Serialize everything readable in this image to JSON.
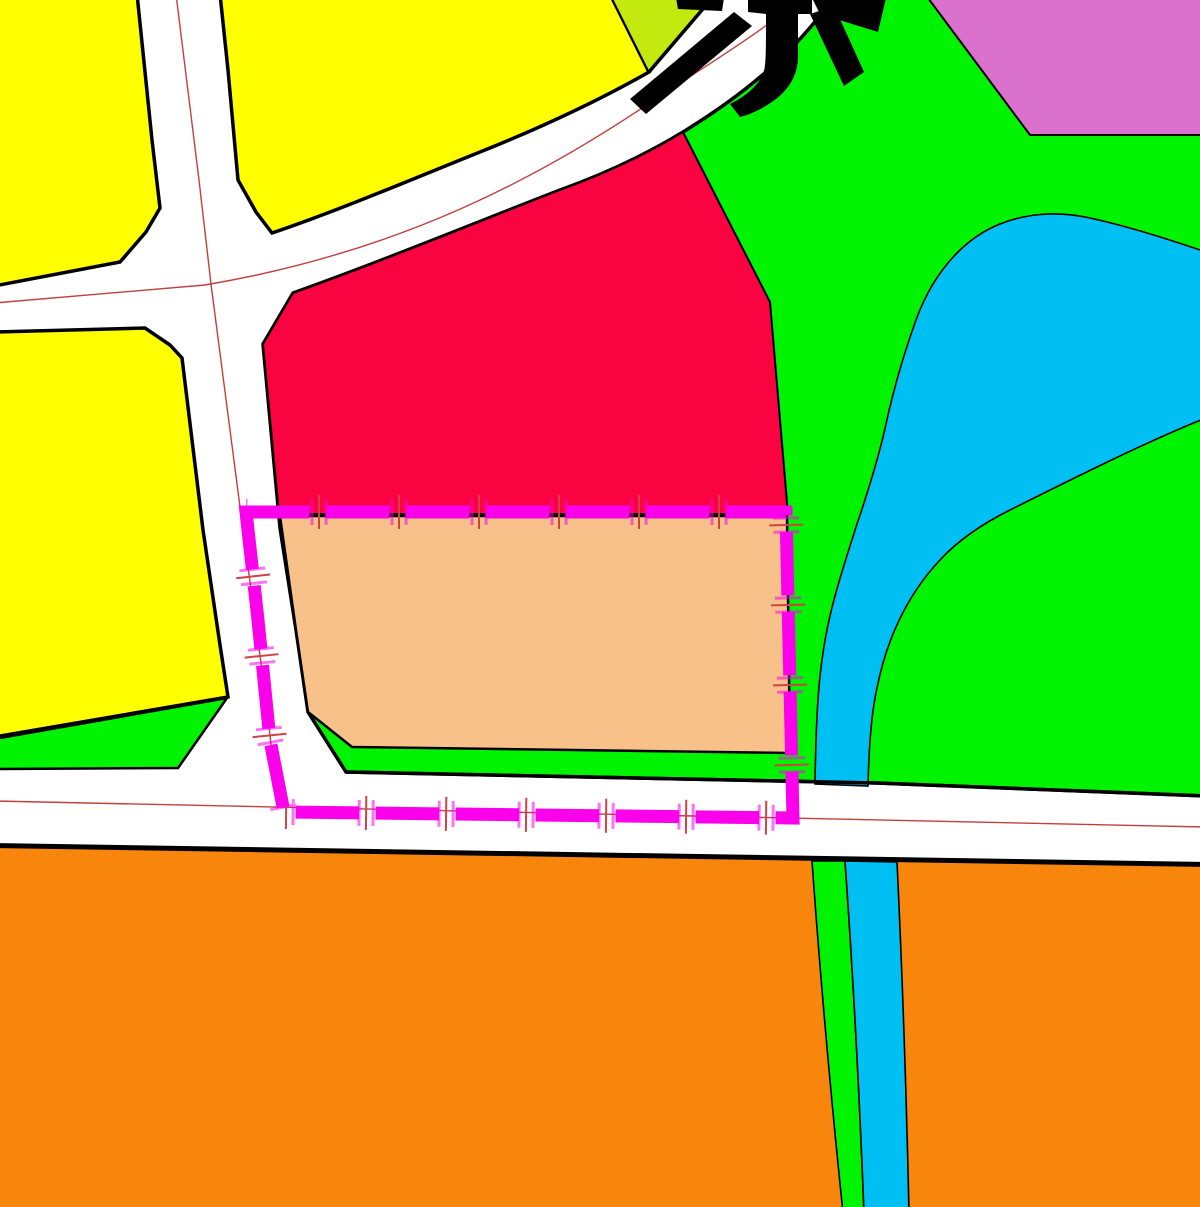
{
  "map": {
    "kind": "land-use zoning map tile",
    "label_glyph": "京",
    "colors": {
      "road_white": "#ffffff",
      "block_yellow": "#ffff00",
      "block_yellowgreen": "#c3e90f",
      "green_space": "#00f300",
      "block_red": "#f90340",
      "block_pink": "#d971cd",
      "water_cyan": "#00bff2",
      "parcel_tan": "#f8c189",
      "block_orange": "#f8860d",
      "boundary_magenta": "#fb00eb",
      "boundary_tick_red": "#cc4444",
      "road_centerline_red": "#c04040",
      "outline_black": "#000000"
    },
    "regions": [
      {
        "name": "yellow-block-northwest",
        "fill": "block_yellow"
      },
      {
        "name": "yellow-block-north",
        "fill": "block_yellow"
      },
      {
        "name": "yellow-block-west",
        "fill": "block_yellow"
      },
      {
        "name": "yellowgreen-wedge",
        "fill": "block_yellowgreen"
      },
      {
        "name": "green-space-main",
        "fill": "green_space"
      },
      {
        "name": "green-buffer-west",
        "fill": "green_space"
      },
      {
        "name": "green-buffer-south",
        "fill": "green_space"
      },
      {
        "name": "red-block-center",
        "fill": "block_red"
      },
      {
        "name": "pink-block-northeast",
        "fill": "block_pink"
      },
      {
        "name": "water-body-and-channel",
        "fill": "water_cyan"
      },
      {
        "name": "selected-parcel",
        "fill": "parcel_tan"
      },
      {
        "name": "orange-block-south",
        "fill": "block_orange"
      }
    ],
    "boundary": {
      "style": "thick magenta dashes with end ticks",
      "shape": "parcel ring following road centerlines"
    },
    "roads": {
      "surface": "white",
      "centerline": "thin red",
      "edges": "black casing"
    }
  }
}
